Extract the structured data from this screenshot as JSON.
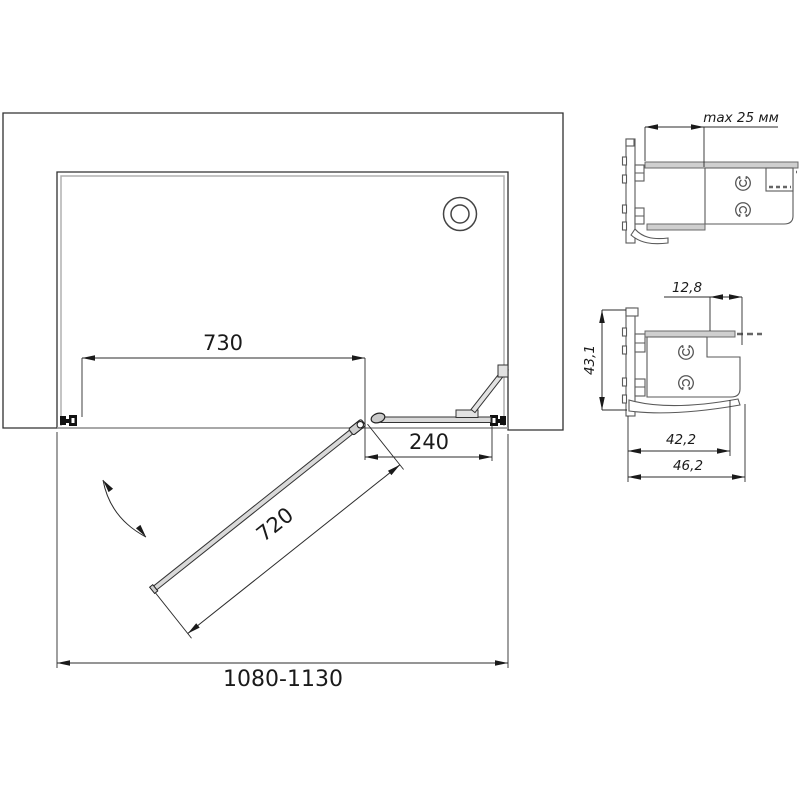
{
  "drawing": {
    "type": "shower-enclosure-plan-technical-drawing",
    "plan_view": {
      "dim_wall_to_pivot": "730",
      "dim_fixed_section": "240",
      "dim_door_width": "720",
      "dim_total_width": "1080-1130",
      "features": [
        "hatched-wall",
        "shower-tray",
        "drain",
        "swing-door",
        "fixed-panel",
        "support-bar",
        "wall-profile-left",
        "wall-profile-right",
        "door-swing-arc"
      ]
    },
    "profile_detail_top": {
      "dim_adjustment_range": "max 25 мм",
      "features": [
        "wall-profile",
        "panel-profile",
        "screw-bosses"
      ]
    },
    "profile_detail_bottom": {
      "dim_overlap": "12,8",
      "dim_height": "43,1",
      "dim_width_inner": "42,2",
      "dim_width_outer": "46,2",
      "features": [
        "wall-profile",
        "panel-profile",
        "screw-bosses"
      ]
    },
    "colors": {
      "line": "#303030",
      "hatch": "#4a4a4a",
      "gray_line": "#9c9c9c",
      "panel_fill": "#d9d9d9",
      "profile_fill": "#cfcfcf",
      "fitting_black": "#111111",
      "background": "#ffffff"
    }
  }
}
